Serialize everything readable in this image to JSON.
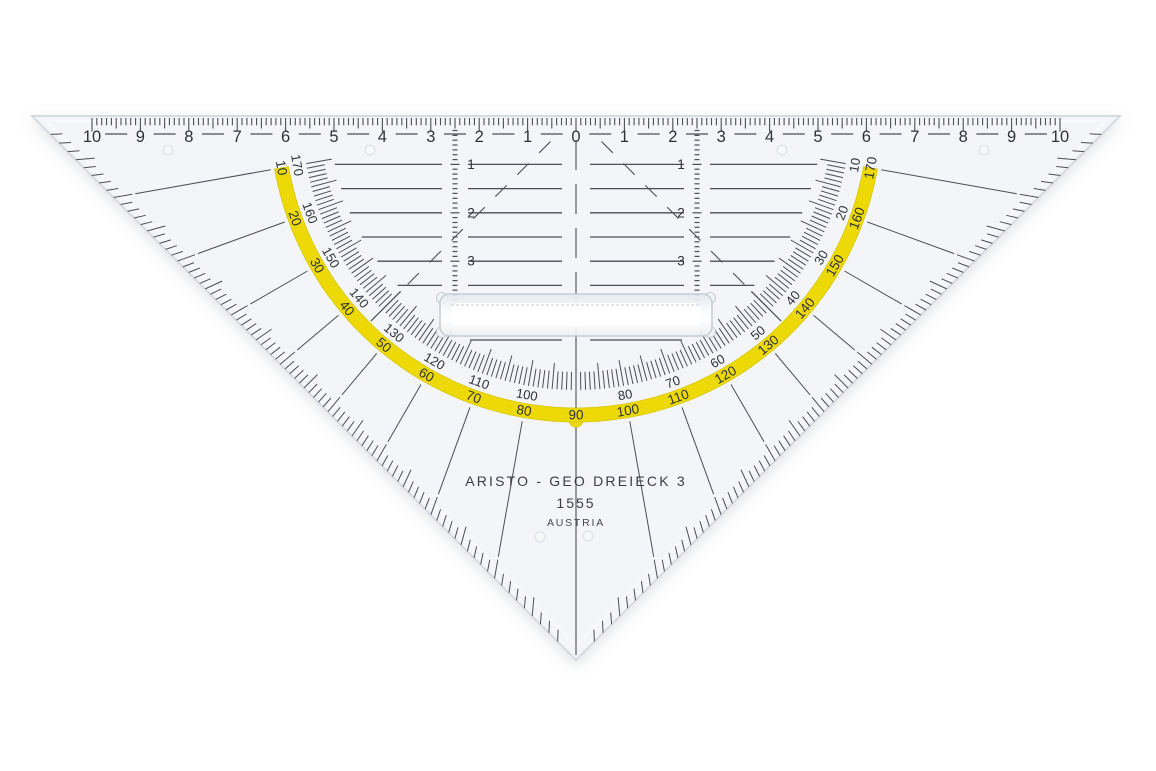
{
  "product": {
    "brand": "ARISTO - GEO DREIECK 3",
    "model": "1555",
    "country": "AUSTRIA"
  },
  "ruler": {
    "labels": [
      "10",
      "9",
      "8",
      "7",
      "6",
      "5",
      "4",
      "3",
      "2",
      "1",
      "0",
      "1",
      "2",
      "3",
      "4",
      "5",
      "6",
      "7",
      "8",
      "9",
      "10"
    ]
  },
  "protractor": {
    "band_values": [
      10,
      20,
      30,
      40,
      50,
      60,
      70,
      80,
      90,
      100,
      110,
      120,
      130,
      140,
      150,
      160,
      170
    ],
    "inner_values": [
      10,
      20,
      30,
      40,
      50,
      60,
      70,
      80,
      100,
      110,
      120,
      130,
      140,
      150,
      160,
      170
    ]
  },
  "depth_scale_labels": [
    "1",
    "2",
    "3"
  ],
  "colors": {
    "background": "#ffffff",
    "body": "#f3f5f8",
    "body_edge": "#d6dbe0",
    "bevel": "#ffffff",
    "ink": "#4a4f54",
    "number_ink": "#2f3337",
    "band_yellow": "#ecd906",
    "band_edge": "#d8c700",
    "handle_edge": "#c6ccd2",
    "handle_fill_top": "#e3e8ec",
    "handle_fill_mid": "#ffffff",
    "handle_fill_bot": "#edf0f3",
    "dot_stroke": "#dde2e6",
    "dot_fill": "#f6f8fa"
  }
}
